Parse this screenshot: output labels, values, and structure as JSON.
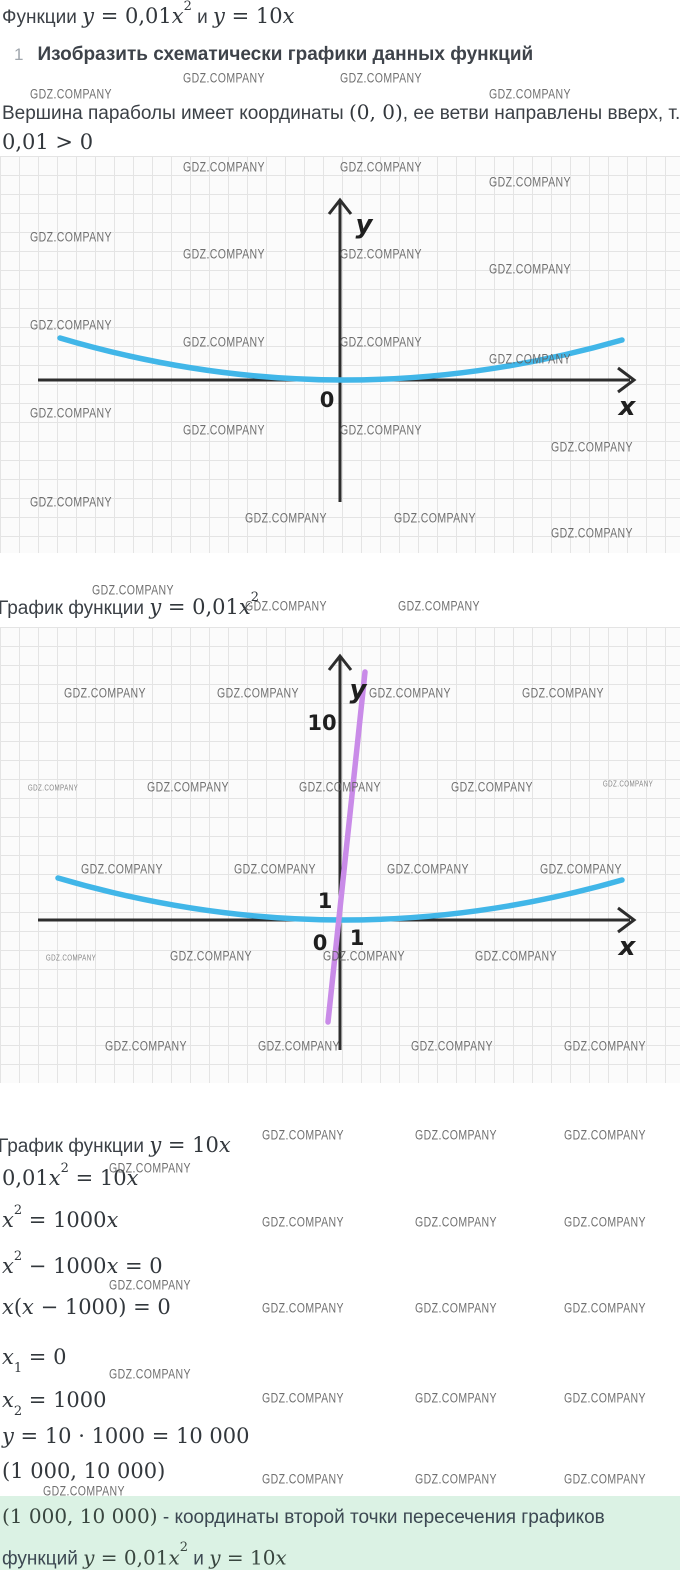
{
  "colors": {
    "parabola_blue": "#41b6e8",
    "line_purple": "#c98be8",
    "axis": "#2d2d2d",
    "grid_line": "#e4e4e4",
    "paper": "#fbfbfb",
    "watermark_gray": "#606060",
    "highlight_bg": "#dbf2e4",
    "text": "#3b4046"
  },
  "header": {
    "title": {
      "pre": "Функции ",
      "f1": "y = 0,01x",
      "f1_sup": "2",
      "mid": " и ",
      "f2": "y = 10x"
    },
    "step": {
      "num": "1",
      "text": "Изобразить схематически графики данных функций"
    },
    "para": {
      "pre": "Вершина параболы имеет координаты ",
      "math": "(0, 0)",
      "post": ", ее ветви направлены вверх, т. к."
    },
    "para2": "0,01 > 0"
  },
  "graph1": {
    "y_label": "y",
    "x_label": "x",
    "origin": "0"
  },
  "caption1": {
    "pre": "График функции ",
    "math": "y = 0,01x",
    "sup": "2"
  },
  "graph2": {
    "y_label": "y",
    "x_label": "x",
    "origin": "0",
    "tick_y10": "10",
    "tick_y1": "1",
    "tick_x1": "1"
  },
  "solution": {
    "caption2": {
      "pre": "График функции ",
      "math": "y = 10x"
    },
    "eq1": {
      "a": "0,01x",
      "sup": "2",
      "b": " = 10x"
    },
    "eq2": {
      "a": "x",
      "sup": "2",
      "b": " = 1000x"
    },
    "eq3": {
      "a": "x",
      "sup": "2",
      "b": " − 1000x = 0"
    },
    "eq4": {
      "a": "x(x − 1000) = 0"
    },
    "eq5": {
      "a": "x",
      "sub": "1",
      "b": " = 0"
    },
    "eq6": {
      "a": "x",
      "sub": "2",
      "b": " = 1000"
    },
    "eq7": {
      "a": "y = 10 · 1000 = 10 000"
    },
    "eq8": {
      "a": "(1 000, 10 000)"
    }
  },
  "conclusion": {
    "math1": "(1 000, 10 000)",
    "text1": " - координаты второй точки пересечения графиков",
    "text2_pre": "функций ",
    "f1": "y = 0,01x",
    "f1_sup": "2",
    "mid": " и ",
    "f2": "y = 10x"
  },
  "chart_data": [
    {
      "type": "line",
      "title": "Схематический график параболы y = 0,01x²",
      "series": [
        {
          "name": "y = 0,01x²",
          "expr": "y = 0.01*x^2",
          "color": "#41b6e8"
        }
      ],
      "xlabel": "x",
      "ylabel": "y",
      "origin_label": "0",
      "grid": true,
      "annotations": [
        "вершина (0, 0)",
        "ветви направлены вверх"
      ]
    },
    {
      "type": "line",
      "title": "Графики y = 0,01x² и y = 10x",
      "series": [
        {
          "name": "y = 0,01x²",
          "expr": "y = 0.01*x^2",
          "color": "#41b6e8"
        },
        {
          "name": "y = 10x",
          "expr": "y = 10*x",
          "color": "#c98be8"
        }
      ],
      "xlabel": "x",
      "ylabel": "y",
      "origin_label": "0",
      "x_ticks": [
        1
      ],
      "y_ticks": [
        1,
        10
      ],
      "grid": true,
      "intersections": [
        [
          0,
          0
        ],
        [
          1000,
          10000
        ]
      ]
    }
  ],
  "watermarks": {
    "text": "GDZ.COMPANY",
    "positions": [
      {
        "x": 224,
        "y": 78
      },
      {
        "x": 381,
        "y": 78
      },
      {
        "x": 71,
        "y": 94
      },
      {
        "x": 530,
        "y": 94
      },
      {
        "x": 224,
        "y": 167
      },
      {
        "x": 381,
        "y": 167
      },
      {
        "x": 530,
        "y": 182
      },
      {
        "x": 71,
        "y": 237
      },
      {
        "x": 224,
        "y": 254
      },
      {
        "x": 381,
        "y": 254
      },
      {
        "x": 530,
        "y": 269
      },
      {
        "x": 71,
        "y": 325
      },
      {
        "x": 224,
        "y": 342
      },
      {
        "x": 381,
        "y": 342
      },
      {
        "x": 530,
        "y": 359
      },
      {
        "x": 71,
        "y": 413
      },
      {
        "x": 224,
        "y": 430
      },
      {
        "x": 381,
        "y": 430
      },
      {
        "x": 592,
        "y": 447
      },
      {
        "x": 71,
        "y": 502
      },
      {
        "x": 286,
        "y": 518
      },
      {
        "x": 435,
        "y": 518
      },
      {
        "x": 592,
        "y": 533
      },
      {
        "x": 133,
        "y": 590
      },
      {
        "x": 286,
        "y": 606
      },
      {
        "x": 439,
        "y": 606
      },
      {
        "x": 105,
        "y": 693
      },
      {
        "x": 258,
        "y": 693
      },
      {
        "x": 410,
        "y": 693
      },
      {
        "x": 563,
        "y": 693
      },
      {
        "x": 53,
        "y": 788,
        "s": 1
      },
      {
        "x": 188,
        "y": 787
      },
      {
        "x": 340,
        "y": 787
      },
      {
        "x": 492,
        "y": 787
      },
      {
        "x": 628,
        "y": 784,
        "s": 1
      },
      {
        "x": 122,
        "y": 869
      },
      {
        "x": 275,
        "y": 869
      },
      {
        "x": 428,
        "y": 869
      },
      {
        "x": 581,
        "y": 869
      },
      {
        "x": 71,
        "y": 958,
        "s": 1
      },
      {
        "x": 211,
        "y": 956
      },
      {
        "x": 364,
        "y": 956
      },
      {
        "x": 516,
        "y": 956
      },
      {
        "x": 146,
        "y": 1046
      },
      {
        "x": 299,
        "y": 1046
      },
      {
        "x": 452,
        "y": 1046
      },
      {
        "x": 605,
        "y": 1046
      },
      {
        "x": 303,
        "y": 1135
      },
      {
        "x": 456,
        "y": 1135
      },
      {
        "x": 605,
        "y": 1135
      },
      {
        "x": 150,
        "y": 1168
      },
      {
        "x": 303,
        "y": 1222
      },
      {
        "x": 456,
        "y": 1222
      },
      {
        "x": 605,
        "y": 1222
      },
      {
        "x": 150,
        "y": 1285
      },
      {
        "x": 303,
        "y": 1308
      },
      {
        "x": 456,
        "y": 1308
      },
      {
        "x": 605,
        "y": 1308
      },
      {
        "x": 150,
        "y": 1374
      },
      {
        "x": 303,
        "y": 1398
      },
      {
        "x": 456,
        "y": 1398
      },
      {
        "x": 605,
        "y": 1398
      },
      {
        "x": 303,
        "y": 1479
      },
      {
        "x": 456,
        "y": 1479
      },
      {
        "x": 605,
        "y": 1479
      },
      {
        "x": 84,
        "y": 1491
      }
    ]
  }
}
